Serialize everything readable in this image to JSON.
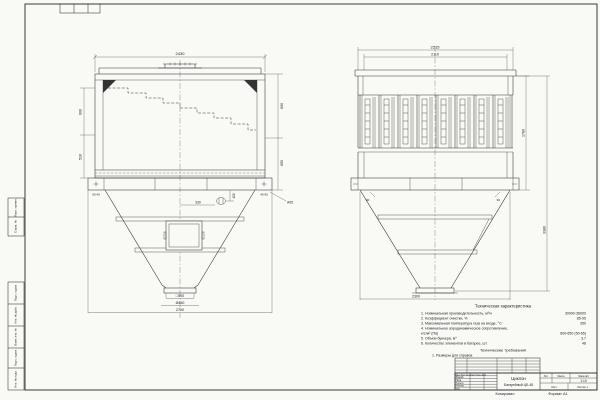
{
  "sheet": {
    "copied_label": "Копировал",
    "format_label": "Формат А1"
  },
  "left_margin_stamps": [
    "Перв. примен.",
    "Справ. №",
    "Подп. и дата",
    "Инв. № дубл.",
    "Взам. инв. №",
    "Подп. и дата",
    "Инв. № подл."
  ],
  "front_view": {
    "dims": {
      "top_width": "2430",
      "left_upper": "600",
      "left_lower": "510",
      "right_upper": "600",
      "right_lower": "650",
      "foot_left": "90 40",
      "foot_right": "40 90",
      "detail_offset": "330",
      "detail_height": "100",
      "weld_note": "А05",
      "outlet_square": "□500",
      "outlet_dia": "Ø450",
      "bottom_width": "2700"
    }
  },
  "side_view": {
    "dims": {
      "top_outer": "2215",
      "top_inner": "2110",
      "body_height": "1780",
      "total_height": "3380",
      "corner_left": "90",
      "corner_right": "90",
      "bottom_width": "2300"
    }
  },
  "tech_characteristics": {
    "title": "Техническая характеристика",
    "items": [
      {
        "label": "1. Номинальная производительность, м³/ч",
        "value": "30000-36000"
      },
      {
        "label": "2. Коэффициент очистки, %",
        "value": "85-95"
      },
      {
        "label": "3. Максимальная температура газа на входе, °С",
        "value": "350"
      },
      {
        "label": "4. Номинальное аэродинамическое сопротивление,",
        "value": ""
      },
      {
        "label": "кгс/м² (Па)",
        "value": "600-650 (50-65)"
      },
      {
        "label": "5. Объем бункера, м³",
        "value": "3,7"
      },
      {
        "label": "6. Количество элементов в батарее, шт",
        "value": "48"
      }
    ],
    "requirements_title": "Технические требования",
    "requirements_item": "1. Размеры для справок."
  },
  "title_block": {
    "product_line1": "Циклон",
    "product_line2": "Батарейный ЦБ-48",
    "header_row": "Изм. Лист  № докум.  Подп.  Дата",
    "rows": [
      "Разраб.",
      "Пров.",
      "Т.контр.",
      "Н.контр.",
      "Утв."
    ],
    "lit_label": "Лит.",
    "mass_label": "Масса",
    "scale_label": "Масштаб",
    "scale_value": "1:10",
    "sheet_label": "Лист",
    "sheets_label": "Листов 1"
  }
}
